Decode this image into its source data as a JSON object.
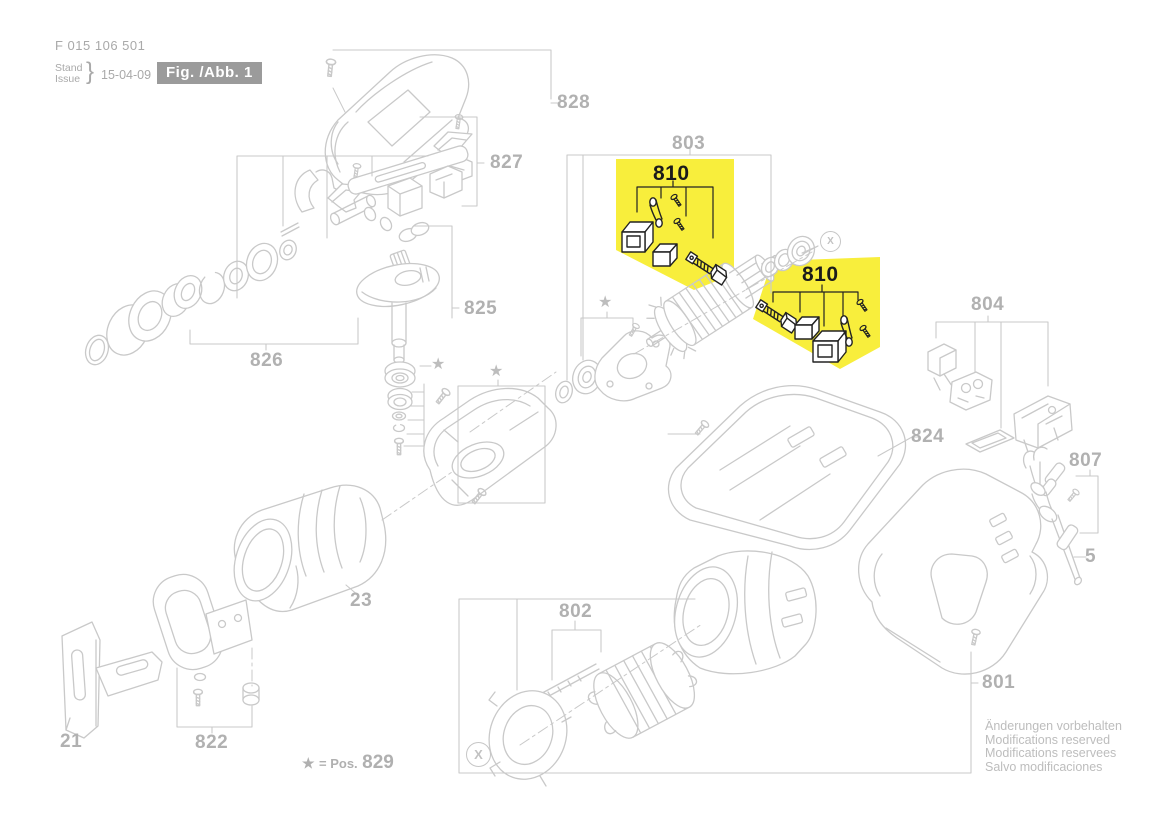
{
  "header": {
    "document_number": "F 015 106 501",
    "stand_label": "Stand",
    "issue_label": "Issue",
    "brace": "}",
    "date": "15-04-09",
    "figure_label": "Fig. /Abb. 1"
  },
  "part_labels": {
    "p828": "828",
    "p827": "827",
    "p826": "826",
    "p825": "825",
    "p824": "824",
    "p822": "822",
    "p821": "21",
    "p23": "23",
    "p803": "803",
    "p804": "804",
    "p807": "807",
    "p802": "802",
    "p801": "801",
    "p810": "810",
    "p5": "5"
  },
  "symbols": {
    "x_marker": "X",
    "star": "★"
  },
  "footer": {
    "star": "★",
    "star_note": "= Pos.",
    "star_note_number": "829",
    "notices": [
      "Änderungen vorbehalten",
      "Modifications reserved",
      "Modifications reservees",
      "Salvo modificaciones"
    ]
  },
  "colors": {
    "highlight_yellow": "#F8EE3C",
    "diagram_line_gray": "#c9c9c9",
    "label_gray": "#b1b1b1",
    "highlight_text_black": "#1b1b1b",
    "figure_box_bg": "#9b9b9b"
  }
}
